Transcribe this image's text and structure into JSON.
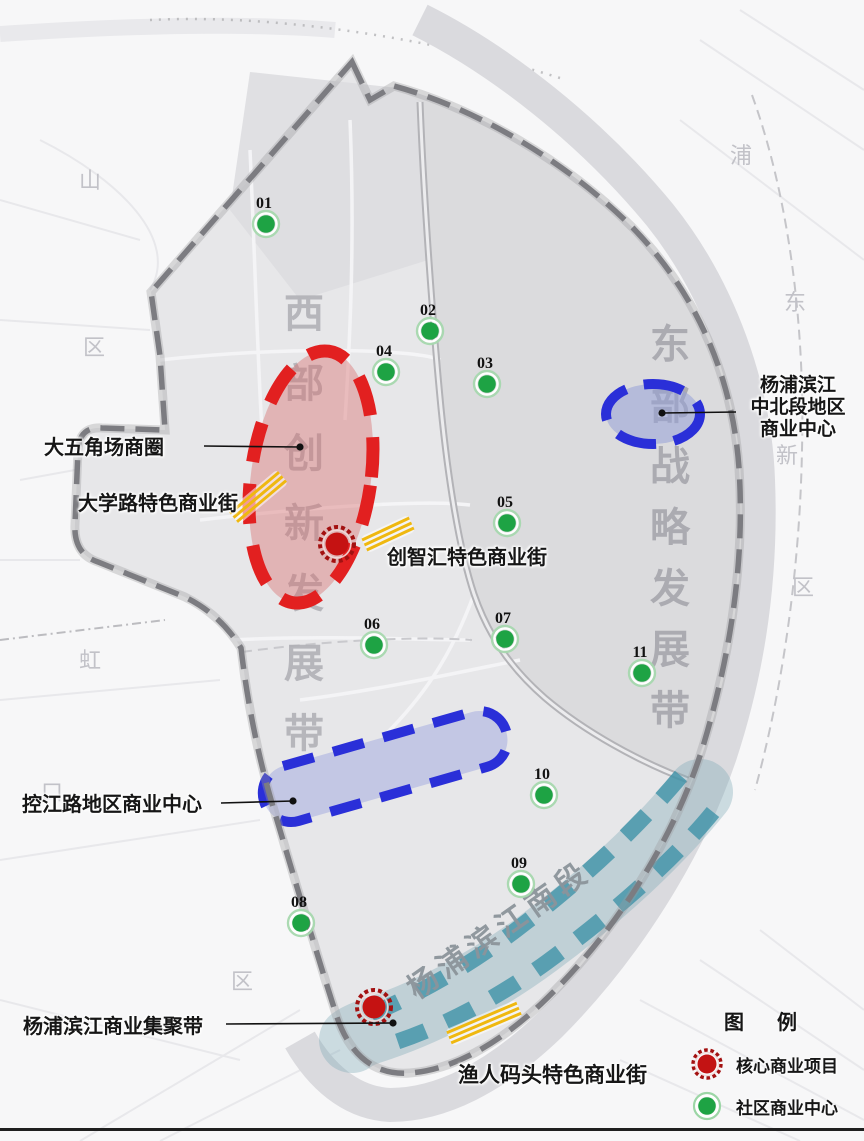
{
  "map_title_watermarks": {
    "west_belt": {
      "text": "西部创新发展带",
      "x": 304,
      "y_start": 327,
      "y_step": 70,
      "color": "#aeaeb4"
    },
    "east_belt": {
      "text": "东部战略发展带",
      "x": 670,
      "y_start": 358,
      "y_step": 61,
      "color": "#a3a3aa"
    }
  },
  "zones": {
    "wujiaochang_ellipse": {
      "stroke": "#e22020",
      "fill": "rgba(217,110,110,0.42)"
    },
    "binjiang_midnorth_ellipse": {
      "stroke": "#2a2fd8",
      "fill": "rgba(150,160,215,0.55)"
    },
    "kongjiang_band": {
      "stroke": "#2a2fd8",
      "fill": "rgba(130,140,220,0.35)"
    },
    "binjiang_south_band": {
      "edge_color": "#3e92a7",
      "fill": "rgba(120,165,180,0.35)",
      "text": "杨浦滨江南段",
      "text_x": 505,
      "text_y": 938,
      "text_rotation": -35,
      "text_color": "#8c949b"
    }
  },
  "annotations": [
    {
      "id": "wujiaochang-label",
      "text": "大五角场商圈",
      "x": 44,
      "y": 436,
      "size": 20,
      "pointer": {
        "x1": 204,
        "y1": 446,
        "x2": 300,
        "y2": 447
      }
    },
    {
      "id": "daxue-road-label",
      "text": "大学路特色商业街",
      "x": 78,
      "y": 492,
      "size": 20
    },
    {
      "id": "chuangzhihui-label",
      "text": "创智汇特色商业街",
      "x": 387,
      "y": 546,
      "size": 20
    },
    {
      "id": "binjiang-midnorth-label",
      "lines": [
        "杨浦滨江",
        "中北段地区",
        "商业中心"
      ],
      "x": 742,
      "y": 374,
      "w": 112,
      "size": 19,
      "align": "center",
      "pointer": {
        "x1": 736,
        "y1": 412,
        "x2": 662,
        "y2": 413
      }
    },
    {
      "id": "kongjiang-label",
      "text": "控江路地区商业中心",
      "x": 22,
      "y": 793,
      "size": 20,
      "pointer": {
        "x1": 221,
        "y1": 803,
        "x2": 293,
        "y2": 801
      }
    },
    {
      "id": "binjiang-cluster-label",
      "text": "杨浦滨江商业集聚带",
      "x": 23,
      "y": 1015,
      "size": 20,
      "pointer": {
        "x1": 226,
        "y1": 1024,
        "x2": 393,
        "y2": 1023
      }
    },
    {
      "id": "yuren-wharf-label",
      "text": "渔人码头特色商业街",
      "x": 458,
      "y": 1063,
      "size": 21
    }
  ],
  "markers": {
    "community_color": "#1ea344",
    "core_color": "#c51212",
    "community": [
      {
        "num": "01",
        "x": 266,
        "y": 224
      },
      {
        "num": "02",
        "x": 430,
        "y": 331
      },
      {
        "num": "03",
        "x": 487,
        "y": 384
      },
      {
        "num": "04",
        "x": 386,
        "y": 372
      },
      {
        "num": "05",
        "x": 507,
        "y": 523
      },
      {
        "num": "06",
        "x": 374,
        "y": 645
      },
      {
        "num": "07",
        "x": 505,
        "y": 639
      },
      {
        "num": "08",
        "x": 301,
        "y": 923
      },
      {
        "num": "09",
        "x": 521,
        "y": 884
      },
      {
        "num": "10",
        "x": 544,
        "y": 795
      },
      {
        "num": "11",
        "x": 642,
        "y": 673
      }
    ],
    "core": [
      {
        "x": 337,
        "y": 544
      },
      {
        "x": 374,
        "y": 1007
      }
    ]
  },
  "streets": {
    "color": "#efb810",
    "items": [
      {
        "name": "daxue-road-street",
        "cx": 258,
        "cy": 497,
        "len": 64,
        "angle": -40
      },
      {
        "name": "chuangzhihui-street",
        "cx": 388,
        "cy": 534,
        "len": 52,
        "angle": -25
      },
      {
        "name": "yuren-wharf-street",
        "cx": 484,
        "cy": 1023,
        "len": 76,
        "angle": -23
      }
    ]
  },
  "background_labels": [
    {
      "t": "山",
      "x": 90,
      "y": 188
    },
    {
      "t": "区",
      "x": 94,
      "y": 355
    },
    {
      "t": "虹",
      "x": 90,
      "y": 668
    },
    {
      "t": "口",
      "x": 52,
      "y": 800
    },
    {
      "t": "浦",
      "x": 741,
      "y": 163
    },
    {
      "t": "东",
      "x": 795,
      "y": 310
    },
    {
      "t": "新",
      "x": 787,
      "y": 463
    },
    {
      "t": "区",
      "x": 803,
      "y": 595
    },
    {
      "t": "区",
      "x": 242,
      "y": 989
    }
  ],
  "legend": {
    "title": "图  例",
    "items": [
      {
        "icon": "core-commercial-dot",
        "color": "#c31313",
        "label": "核心商业项目"
      },
      {
        "icon": "community-commercial-dot",
        "color": "#1ea344",
        "label": "社区商业中心"
      }
    ]
  }
}
